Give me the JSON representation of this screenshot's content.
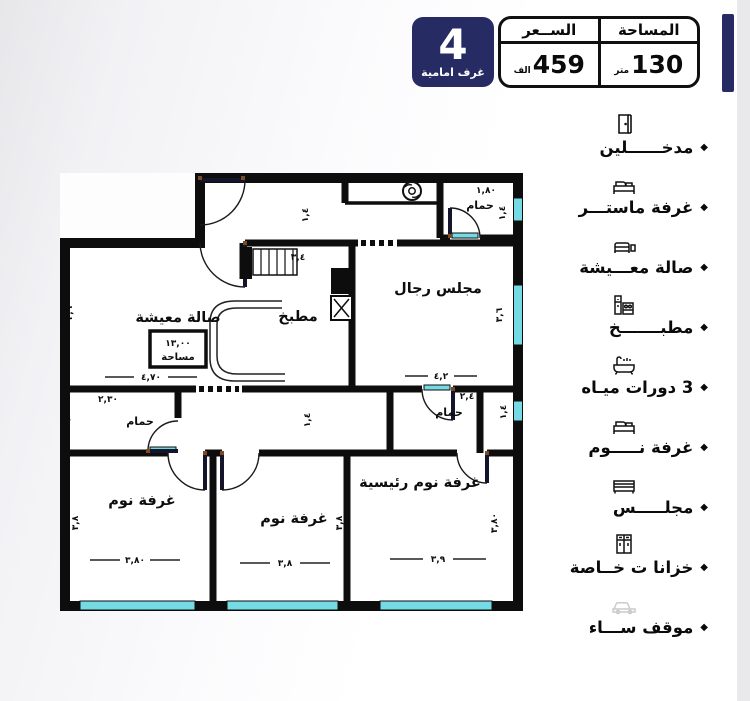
{
  "header": {
    "badge_number": "4",
    "badge_label": "غرف امامية",
    "area_label": "المساحة",
    "price_label": "الســعر",
    "area_value": "130",
    "area_unit": "متر",
    "price_value": "459",
    "price_unit": "الف"
  },
  "sidebar": {
    "bullet": "◆",
    "items": [
      {
        "icon": "door-icon",
        "label": "مدخــــــلين"
      },
      {
        "icon": "bed-icon",
        "label": "غرفة ماستـــر"
      },
      {
        "icon": "sofa-icon",
        "label": "صالة معـــيشة"
      },
      {
        "icon": "kitchen-icon",
        "label": "مطبـــــــخ"
      },
      {
        "icon": "bathtub-icon",
        "label": "3 دورات ميـاه"
      },
      {
        "icon": "bed-icon",
        "label": "غرفة نـــــوم"
      },
      {
        "icon": "majlis-sofa-icon",
        "label": "مجلـــــس"
      },
      {
        "icon": "closet-icon",
        "label": "خزانا ت خــاصة"
      },
      {
        "icon": "parking-icon",
        "label": "موقف ســـاء"
      }
    ]
  },
  "floorplan": {
    "labels": {
      "living": "صالة معيشة",
      "kitchen": "مطبخ",
      "majlis": "مجلس رجال",
      "bath": "حمام",
      "bedroom": "غرفة نوم",
      "master": "غرفة نوم رئيسية",
      "area_box_value": "١٣,٠٠",
      "area_box_word": "مساحة"
    },
    "dimensions": {
      "d470": "٤,٧٠",
      "d34": "٣,٤",
      "d42": "٤,٢",
      "d36": "٣,٦",
      "d180": "١,٨٠",
      "d230": "٢,٣٠",
      "d380": "٣,٨٠",
      "d38": "٣,٨",
      "d39": "٣,٩",
      "d24": "٢,٤",
      "d14": "١,٤"
    },
    "colors": {
      "wall": "#0d0d0d",
      "window": "#74dae3",
      "accent_navy": "#272b63"
    }
  }
}
